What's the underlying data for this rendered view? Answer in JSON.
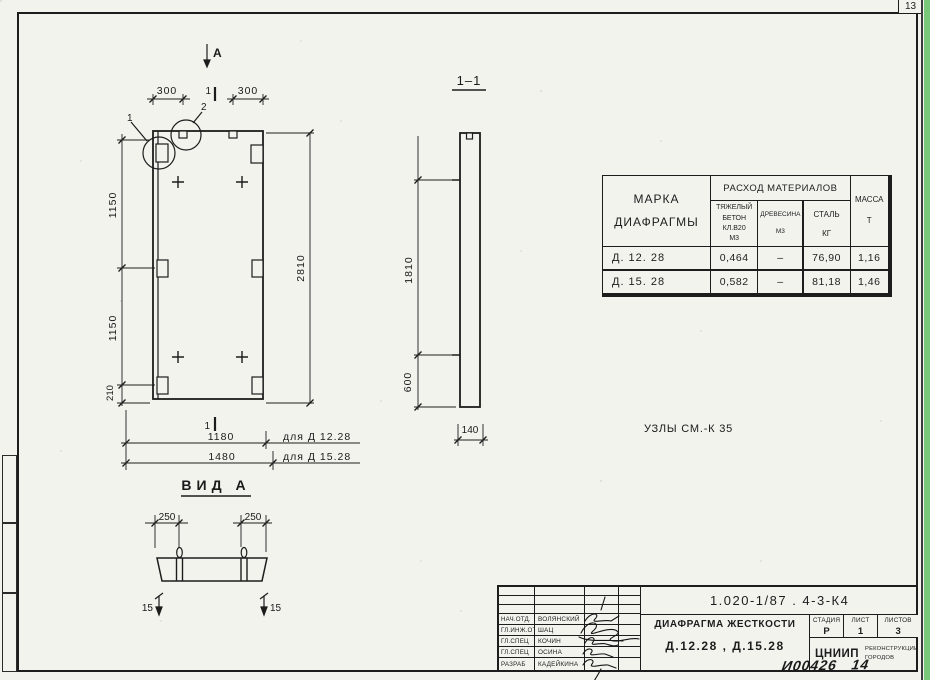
{
  "page": {
    "corner_number": "13"
  },
  "plan": {
    "view_arrow_label": "А",
    "detail_mark_1": "1",
    "detail_mark_2": "2",
    "section_mark_top": "1",
    "section_mark_bottom": "1",
    "dim_top_left": "300",
    "dim_top_right": "300",
    "dim_left_upper": "1150",
    "dim_left_lower": "1150",
    "dim_left_bottom": "210",
    "dim_height": "2810",
    "dim_width_1": "1180",
    "dim_width_1_note": "для Д 12.28",
    "dim_width_2": "1480",
    "dim_width_2_note": "для Д 15.28"
  },
  "section": {
    "title": "1–1",
    "dim_upper": "1810",
    "dim_lower": "600",
    "dim_width": "140"
  },
  "view_a": {
    "title": "ВИД А",
    "dim_left": "250",
    "dim_right": "250",
    "dim_offset_left": "15",
    "dim_offset_right": "15"
  },
  "notes": {
    "uzly": "УЗЛЫ СМ.-К 35"
  },
  "materials_table": {
    "header_marka": "МАРКА\nДИАФРАГМЫ",
    "header_rashod": "РАСХОД МАТЕРИАЛОВ",
    "header_beton": "ТЯЖЕЛЫЙ\nБЕТОН\nКЛ.В20\nМ3",
    "header_drevesina": "ДРЕВЕСИНА\nМ3",
    "header_stal": "СТАЛЬ\nКГ",
    "header_massa": "МАССА\nТ",
    "rows": [
      {
        "marka": "Д. 12. 28",
        "beton": "0,464",
        "drevesina": "–",
        "stal": "76,90",
        "massa": "1,16"
      },
      {
        "marka": "Д. 15. 28",
        "beton": "0,582",
        "drevesina": "–",
        "stal": "81,18",
        "massa": "1,46"
      }
    ]
  },
  "title_block": {
    "doc_number": "1.020-1/87 . 4-3-К4",
    "title": "ДИАФРАГМА ЖЕСТКОСТИ",
    "subtitle": "Д.12.28 , Д.15.28",
    "stage_label": "СТАДИЯ",
    "sheet_label": "ЛИСТ",
    "sheets_label": "ЛИСТОВ",
    "stage": "Р",
    "sheet_no": "1",
    "sheets_total": "3",
    "org": "ЦНИИП",
    "org_division": "РЕКОНСТРУКЦИИ\nГОРОДОВ",
    "signers": [
      {
        "role": "НАЧ.ОТД.",
        "name": "ВОЛЯНСКИЙ"
      },
      {
        "role": "ГЛ.ИНЖ.ОТД.",
        "name": "ШАЦ"
      },
      {
        "role": "ГЛ.СПЕЦ",
        "name": "КОЧИН"
      },
      {
        "role": "ГЛ.СПЕЦ",
        "name": "ОСИНА"
      },
      {
        "role": "РАЗРАБ",
        "name": "КАДЕЙКИНА"
      }
    ],
    "handwritten_number": "И00426   14"
  }
}
